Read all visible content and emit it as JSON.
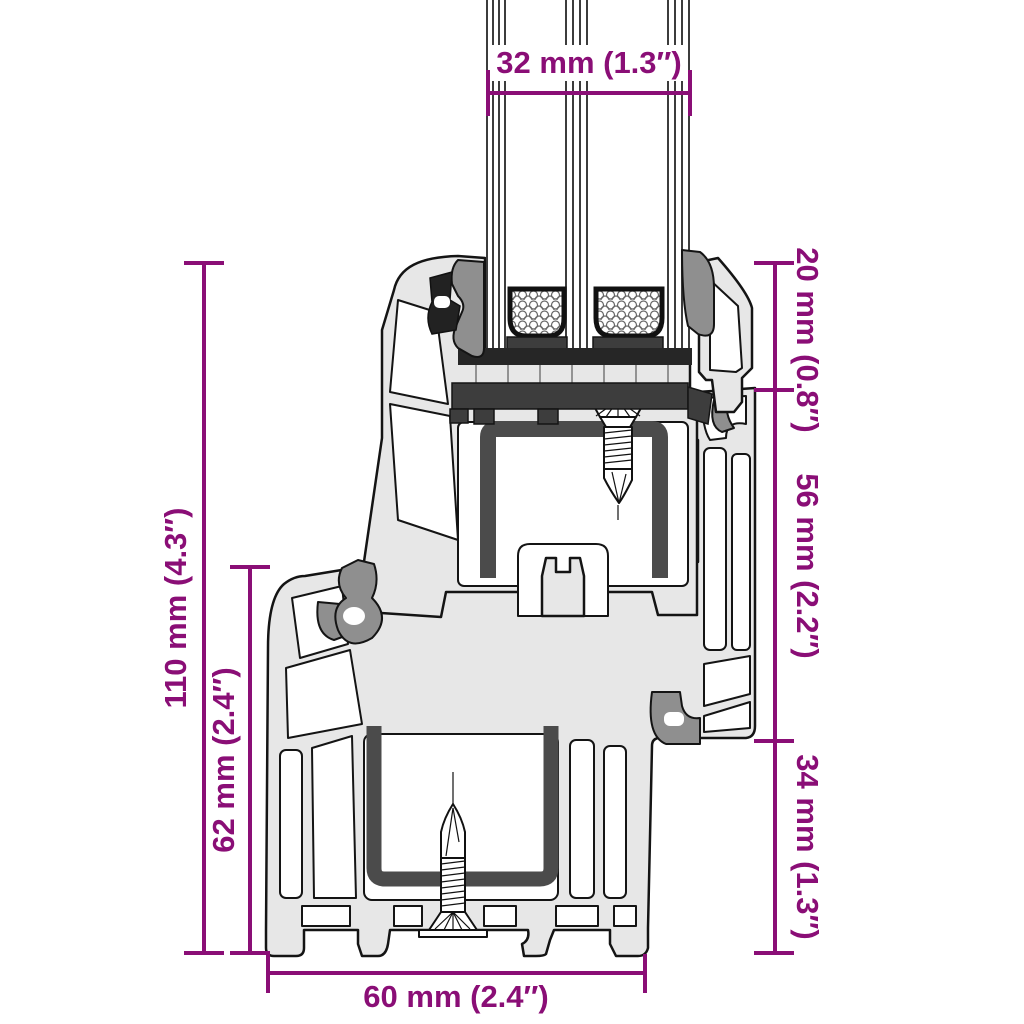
{
  "diagram": {
    "title": "Window frame profile cross-section with dimensions",
    "type": "technical-drawing",
    "dims": {
      "glazing": {
        "mm": 32,
        "inch": 1.3,
        "label": "32 mm (1.3″)"
      },
      "total": {
        "mm": 110,
        "inch": 4.3,
        "label": "110 mm (4.3″)"
      },
      "frame": {
        "mm": 62,
        "inch": 2.4,
        "label": "62 mm (2.4″)"
      },
      "top": {
        "mm": 20,
        "inch": 0.8,
        "label": "20 mm (0.8″)"
      },
      "middle": {
        "mm": 56,
        "inch": 2.2,
        "label": "56 mm (2.2″)"
      },
      "lower": {
        "mm": 34,
        "inch": 1.3,
        "label": "34 mm (1.3″)"
      },
      "depth": {
        "mm": 60,
        "inch": 2.4,
        "label": "60 mm (2.4″)"
      }
    },
    "components": [
      "triple-glazing",
      "glazing-spacers",
      "sash-profile",
      "frame-profile",
      "steel-reinforcement-sash",
      "steel-reinforcement-frame",
      "fastening-screw-sash",
      "fastening-screw-frame",
      "rubber-gaskets"
    ],
    "colors": {
      "accent": "#8A0E76",
      "profile": "#E7E7E7",
      "outline": "#141414",
      "steel": "#4B4B4B",
      "gasket": "#8F8F8F",
      "dark": "#3D3D3D",
      "black": "#262626",
      "bg": "#FFFFFF"
    }
  }
}
